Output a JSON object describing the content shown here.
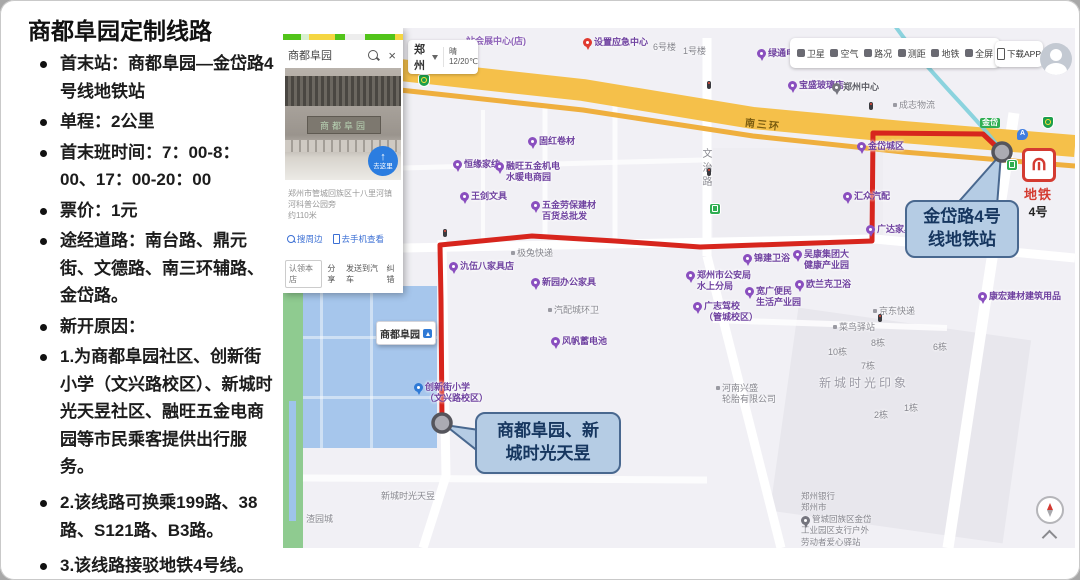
{
  "slide": {
    "title": "商都阜园定制线路",
    "bullets": [
      "首末站：商都阜园—金岱路4号线地铁站",
      "单程：2公里",
      "首末班时间：7：00-8：00、17：00-20：00",
      "票价：1元",
      "途经道路：南台路、鼎元街、文德路、南三环辅路、金岱路。",
      "新开原因：",
      "1.为商都阜园社区、创新街小学（文兴路校区）、新城时光天昱社区、融旺五金电商园等市民乘客提供出行服务。",
      "2.该线路可换乘199路、38路、S121路、B3路。",
      "3.该线路接驳地铁4号线。"
    ]
  },
  "map": {
    "panel": {
      "query": "商都阜园",
      "photo_sign": "商都阜园",
      "goto_label": "去这里",
      "address": "郑州市管城回族区十八里河镇河科普公园旁",
      "distance": "约110米",
      "nearby_link": "搜周边",
      "phone_link": "去手机查看",
      "claim_button": "认领本店",
      "share_link": "分享",
      "send_car_link": "发送到汽车",
      "fix_link": "纠错"
    },
    "city": {
      "name": "郑州",
      "weather": "晴",
      "temp": "12/20℃"
    },
    "toolbar": [
      {
        "label": "卫星",
        "icon": "satellite-icon"
      },
      {
        "label": "空气",
        "icon": "air-quality-icon"
      },
      {
        "label": "路况",
        "icon": "traffic-icon"
      },
      {
        "label": "测距",
        "icon": "measure-icon"
      },
      {
        "label": "地铁",
        "icon": "subway-icon"
      },
      {
        "label": "全屏",
        "icon": "fullscreen-icon"
      }
    ],
    "download_app": "下载APP",
    "labels": {
      "ring_road": "南三环",
      "vertical_road": "文治路"
    },
    "metro_badge": {
      "title": "地铁",
      "line": "4号"
    },
    "callouts": {
      "station": {
        "line1": "金岱路4号",
        "line2": "线地铁站"
      },
      "origin": {
        "line1": "商都阜园、新",
        "line2": "城时光天昱"
      }
    },
    "origin_label": "商都阜园",
    "bank": {
      "lines": [
        "郑州银行",
        "郑州市",
        "管城回族区金岱",
        "工业园区支行户外",
        "劳动者爱心驿站"
      ]
    },
    "pois": [
      {
        "t": "站会展中心(店)",
        "x": 183,
        "y": 8,
        "k": "purpletext"
      },
      {
        "t": "设置应急中心",
        "x": 300,
        "y": 9,
        "k": "redpin"
      },
      {
        "t": "6号楼",
        "x": 370,
        "y": 14,
        "k": "plain"
      },
      {
        "t": "1号楼",
        "x": 400,
        "y": 18,
        "k": "plain"
      },
      {
        "t": "绿通电动车",
        "x": 474,
        "y": 20,
        "k": "purple"
      },
      {
        "t": "宝盛玻璃店",
        "x": 505,
        "y": 52,
        "k": "purple"
      },
      {
        "t": "郑州中心",
        "x": 549,
        "y": 54,
        "k": "graypin"
      },
      {
        "t": "成志物流",
        "x": 610,
        "y": 72,
        "k": "dot"
      },
      {
        "t": "金岱",
        "x": 697,
        "y": 90,
        "k": "roadtag"
      },
      {
        "t": "固红卷材",
        "x": 245,
        "y": 108,
        "k": "purple"
      },
      {
        "t": "恒缘家纺",
        "x": 170,
        "y": 131,
        "k": "purple"
      },
      {
        "t": "融旺五金机电",
        "t2": "水暖电商园",
        "x": 212,
        "y": 133,
        "k": "purple"
      },
      {
        "t": "金岱城区",
        "x": 574,
        "y": 113,
        "k": "purple"
      },
      {
        "t": "王剑文具",
        "x": 177,
        "y": 163,
        "k": "purple"
      },
      {
        "t": "五金劳保建材",
        "t2": "百货总批发",
        "x": 248,
        "y": 172,
        "k": "purple"
      },
      {
        "t": "汇众汽配",
        "x": 560,
        "y": 163,
        "k": "purple"
      },
      {
        "t": "广达家具",
        "x": 583,
        "y": 196,
        "k": "purple"
      },
      {
        "t": "极兔快递",
        "x": 228,
        "y": 220,
        "k": "dot"
      },
      {
        "t": "氿伍八家具店",
        "x": 166,
        "y": 233,
        "k": "purple"
      },
      {
        "t": "新园办公家具",
        "x": 248,
        "y": 249,
        "k": "purple"
      },
      {
        "t": "郑州市公安局",
        "t2": "水上分局",
        "x": 403,
        "y": 242,
        "k": "purple"
      },
      {
        "t": "锦建卫浴",
        "x": 460,
        "y": 225,
        "k": "purple"
      },
      {
        "t": "吴康集团大",
        "t2": "健康产业园",
        "x": 510,
        "y": 221,
        "k": "purple"
      },
      {
        "t": "欧兰克卫浴",
        "x": 512,
        "y": 251,
        "k": "purple"
      },
      {
        "t": "宽广便民",
        "t2": "生活产业园",
        "x": 462,
        "y": 258,
        "k": "purple"
      },
      {
        "t": "广志驾校",
        "t2": "（管城校区）",
        "x": 410,
        "y": 273,
        "k": "purple"
      },
      {
        "t": "康宏建材建筑用品",
        "x": 695,
        "y": 263,
        "k": "purple"
      },
      {
        "t": "汽配城环卫",
        "x": 265,
        "y": 277,
        "k": "dot"
      },
      {
        "t": "风帆蓄电池",
        "x": 268,
        "y": 308,
        "k": "purple"
      },
      {
        "t": "京东快递",
        "x": 590,
        "y": 278,
        "k": "dot"
      },
      {
        "t": "菜鸟驿站",
        "x": 550,
        "y": 294,
        "k": "dot"
      },
      {
        "t": "8栋",
        "x": 588,
        "y": 310,
        "k": "plain"
      },
      {
        "t": "10栋",
        "x": 545,
        "y": 319,
        "k": "plain"
      },
      {
        "t": "7栋",
        "x": 578,
        "y": 333,
        "k": "plain"
      },
      {
        "t": "6栋",
        "x": 650,
        "y": 314,
        "k": "plain"
      },
      {
        "t": "新城时光印象",
        "x": 536,
        "y": 348,
        "k": "watermark"
      },
      {
        "t": "1栋",
        "x": 621,
        "y": 375,
        "k": "plain"
      },
      {
        "t": "2栋",
        "x": 591,
        "y": 382,
        "k": "plain"
      },
      {
        "t": "河南兴盛",
        "t2": "轮胎有限公司",
        "x": 433,
        "y": 355,
        "k": "dot"
      },
      {
        "t": "创新街小学",
        "t2": "（文兴路校区）",
        "x": 131,
        "y": 354,
        "k": "blue"
      },
      {
        "t": "新城时光天昱",
        "x": 98,
        "y": 463,
        "k": "plain"
      },
      {
        "t": "渣园城",
        "x": 23,
        "y": 486,
        "k": "plain"
      },
      {
        "k": "green",
        "x": 427,
        "y": 176,
        "n": "bus-stop-icon"
      },
      {
        "k": "green",
        "x": 724,
        "y": 132,
        "n": "bus-stop-icon"
      },
      {
        "k": "shield",
        "x": 136,
        "y": 47,
        "n": "highway-shield-icon"
      },
      {
        "k": "shield",
        "x": 760,
        "y": 89,
        "n": "highway-shield-icon"
      },
      {
        "t": "A",
        "k": "bluepad",
        "x": 734,
        "y": 101,
        "n": "metro-entrance-icon"
      },
      {
        "k": "light",
        "x": 424,
        "y": 53,
        "n": "traffic-light-icon"
      },
      {
        "k": "light",
        "x": 586,
        "y": 74,
        "n": "traffic-light-icon"
      },
      {
        "k": "light",
        "x": 160,
        "y": 201,
        "n": "traffic-light-icon"
      },
      {
        "k": "light",
        "x": 595,
        "y": 286,
        "n": "traffic-light-icon"
      },
      {
        "k": "light",
        "x": 424,
        "y": 140,
        "n": "traffic-light-icon"
      }
    ]
  },
  "colors": {
    "route_red": "#d7251d",
    "ring_road_yellow": "#f5c04a",
    "water_blue": "#a6c6ec",
    "callout_bg": "#b5cce4",
    "callout_border": "#49688f",
    "metro_red": "#d43b31"
  }
}
